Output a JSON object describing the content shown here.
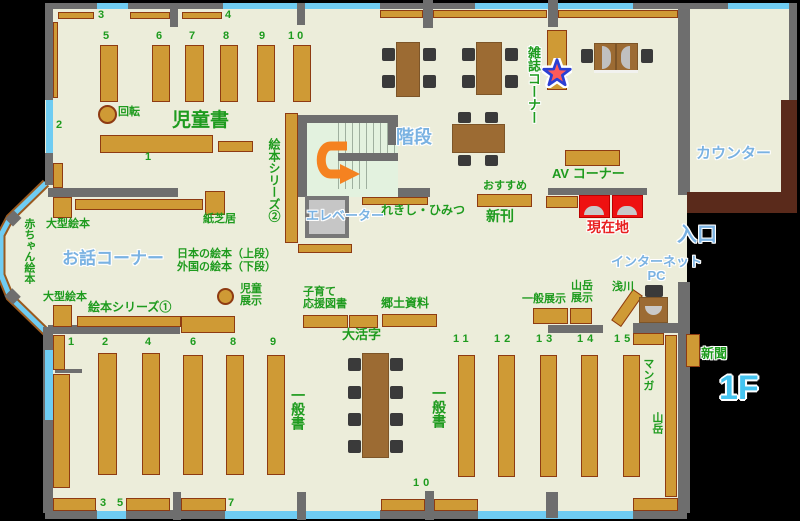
{
  "floor_badge": "1F",
  "colors": {
    "background": "#000000",
    "floor": "#ecedda",
    "wall": "#6e6e6e",
    "window_blue": "#6fccf2",
    "shelf_fill": "#cf9a35",
    "shelf_border": "#8e3b12",
    "table_brown": "#9c6b33",
    "chair_dark": "#3a3a3a",
    "counter_desk_brown": "#5a2a1b",
    "gate_red": "#ee1111",
    "label_green": "#1e9b1e",
    "label_blue": "#7ab2e2",
    "label_red": "#e82020",
    "arrow_orange": "#f58220",
    "stairs_green": "#e3f2df",
    "elevator_gray": "#c6c6c6",
    "star_red": "#ff5a5a",
    "star_outline_blue": "#2b3fd4"
  },
  "labels": {
    "children_books": "児童書",
    "rotation": "回転",
    "stairs": "階段",
    "elevator": "エレベーター",
    "magazine_corner": "雑誌コーナー",
    "counter": "カウンター",
    "av_corner": "AV コーナー",
    "recommended": "おすすめ",
    "new_arrivals": "新刊",
    "current_location": "現在地",
    "entrance": "入口",
    "internet": "インターネット",
    "pc": "PC",
    "history_secrets": "れきし・ひみつ",
    "picture_series_2": "絵本シリーズ②",
    "kamishibai": "紙芝居",
    "large_picture_books": "大型絵本",
    "baby_picture_books": "赤ちゃん絵本",
    "story_corner": "お話コーナー",
    "japanese_picture_books": "日本の絵本（上段）",
    "foreign_picture_books": "外国の絵本（下段）",
    "children_display_1": "児童",
    "children_display_2": "展示",
    "picture_series_1": "絵本シリーズ①",
    "childcare_1": "子育て",
    "childcare_2": "応援図書",
    "large_print": "大活字",
    "local_materials": "郷土資料",
    "general_books": "一般書",
    "general_display": "一般展示",
    "mountain_display_1": "山岳",
    "mountain_display_2": "展示",
    "asakawa": "浅川",
    "manga": "マンガ",
    "mountain": "山岳",
    "newspaper": "新聞"
  },
  "numbers": {
    "1": "1",
    "2": "2",
    "3": "3",
    "4": "4",
    "5": "5",
    "6": "6",
    "7": "7",
    "8": "8",
    "9": "9",
    "10": "10",
    "11": "11",
    "12": "12",
    "13": "13",
    "14": "14",
    "15": "15"
  }
}
